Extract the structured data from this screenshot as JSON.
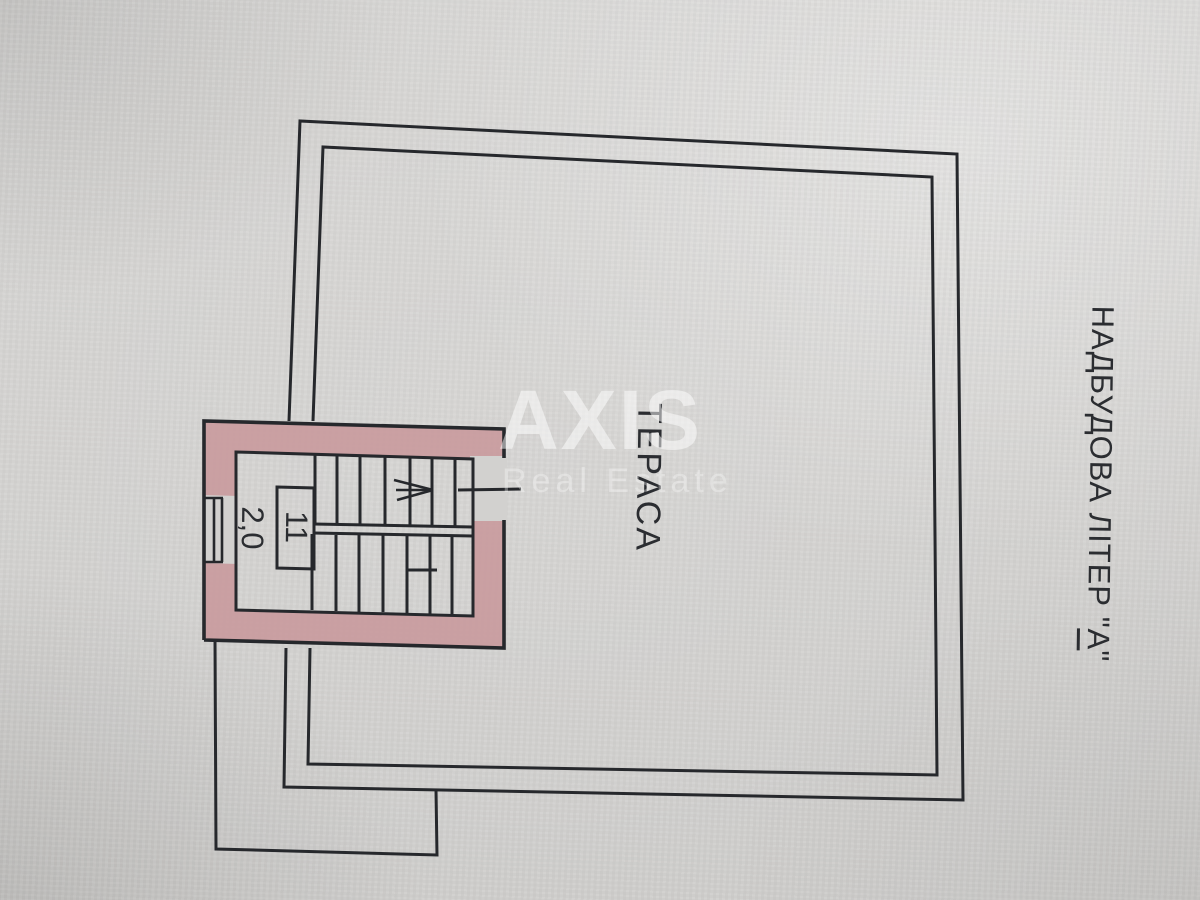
{
  "plan": {
    "room_label": "ТЕРАСА",
    "room_number": "11",
    "room_area": "2,0",
    "title": {
      "prefix": "НАДБУДОВА ЛІТЕР \"",
      "letter": "А",
      "suffix": "\""
    }
  },
  "watermark": {
    "brand": "AXIS",
    "tagline": "Real Estate"
  },
  "icons": {
    "stairs_direction_arrow": "→"
  },
  "colors": {
    "paper": "#d2d1cf",
    "ink": "#26282c",
    "wall_fill": "#c8969a",
    "label_text": "#2b2d31",
    "watermark_strong": "rgba(255,255,255,0.50)",
    "watermark_soft": "rgba(255,255,255,0.32)"
  }
}
